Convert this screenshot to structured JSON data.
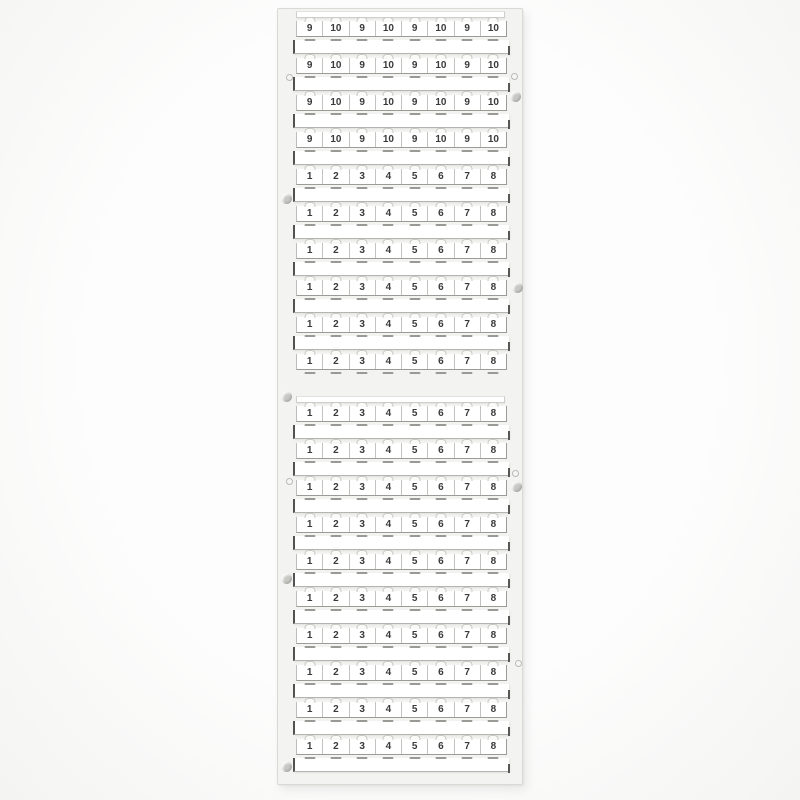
{
  "image": {
    "subject": "terminal-block-marker-card",
    "description": "White plastic marker card with two sheets of numbered break-off marker strips",
    "background_color": "#fbfbfa",
    "card_color": "#f3f3f1",
    "marker_color": "#ffffff",
    "digit_color": "#3a3a3a"
  },
  "card": {
    "sections": [
      {
        "name": "upper-marker-sheet",
        "rows": [
          {
            "labels": [
              "9",
              "10",
              "9",
              "10",
              "9",
              "10",
              "9",
              "10"
            ]
          },
          {
            "labels": [
              "9",
              "10",
              "9",
              "10",
              "9",
              "10",
              "9",
              "10"
            ]
          },
          {
            "labels": [
              "9",
              "10",
              "9",
              "10",
              "9",
              "10",
              "9",
              "10"
            ]
          },
          {
            "labels": [
              "9",
              "10",
              "9",
              "10",
              "9",
              "10",
              "9",
              "10"
            ]
          },
          {
            "labels": [
              "1",
              "2",
              "3",
              "4",
              "5",
              "6",
              "7",
              "8"
            ]
          },
          {
            "labels": [
              "1",
              "2",
              "3",
              "4",
              "5",
              "6",
              "7",
              "8"
            ]
          },
          {
            "labels": [
              "1",
              "2",
              "3",
              "4",
              "5",
              "6",
              "7",
              "8"
            ]
          },
          {
            "labels": [
              "1",
              "2",
              "3",
              "4",
              "5",
              "6",
              "7",
              "8"
            ]
          },
          {
            "labels": [
              "1",
              "2",
              "3",
              "4",
              "5",
              "6",
              "7",
              "8"
            ]
          },
          {
            "labels": [
              "1",
              "2",
              "3",
              "4",
              "5",
              "6",
              "7",
              "8"
            ]
          }
        ]
      },
      {
        "name": "lower-marker-sheet",
        "rows": [
          {
            "labels": [
              "1",
              "2",
              "3",
              "4",
              "5",
              "6",
              "7",
              "8"
            ]
          },
          {
            "labels": [
              "1",
              "2",
              "3",
              "4",
              "5",
              "6",
              "7",
              "8"
            ]
          },
          {
            "labels": [
              "1",
              "2",
              "3",
              "4",
              "5",
              "6",
              "7",
              "8"
            ]
          },
          {
            "labels": [
              "1",
              "2",
              "3",
              "4",
              "5",
              "6",
              "7",
              "8"
            ]
          },
          {
            "labels": [
              "1",
              "2",
              "3",
              "4",
              "5",
              "6",
              "7",
              "8"
            ]
          },
          {
            "labels": [
              "1",
              "2",
              "3",
              "4",
              "5",
              "6",
              "7",
              "8"
            ]
          },
          {
            "labels": [
              "1",
              "2",
              "3",
              "4",
              "5",
              "6",
              "7",
              "8"
            ]
          },
          {
            "labels": [
              "1",
              "2",
              "3",
              "4",
              "5",
              "6",
              "7",
              "8"
            ]
          },
          {
            "labels": [
              "1",
              "2",
              "3",
              "4",
              "5",
              "6",
              "7",
              "8"
            ]
          },
          {
            "labels": [
              "1",
              "2",
              "3",
              "4",
              "5",
              "6",
              "7",
              "8"
            ]
          }
        ]
      }
    ]
  }
}
